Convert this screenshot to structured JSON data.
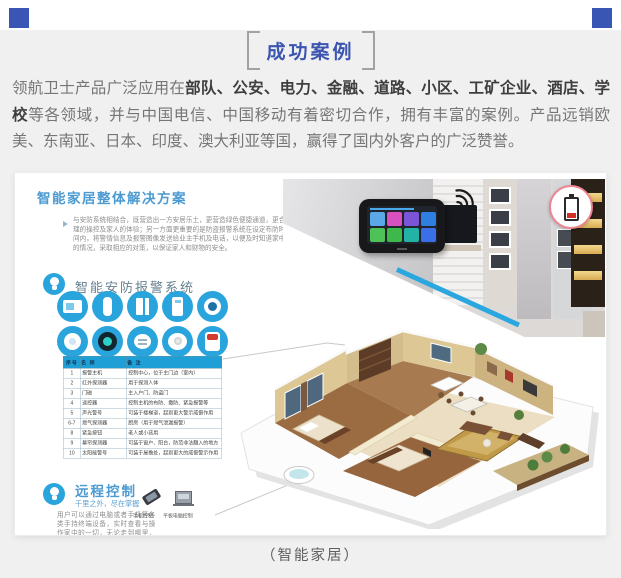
{
  "header": {
    "badge_title": "成功案例"
  },
  "intro": {
    "lead": "领航卫士产品广泛应用在",
    "bold_fields": "部队、公安、电力、金融、道路、小区、工矿企业、酒店、学校",
    "rest": "等各领域，并与中国电信、中国移动有着密切合作，拥有丰富的案例。产品远销欧美、东南亚、日本、印度、澳大利亚等国，赢得了国内外客户的广泛赞誉。"
  },
  "brochure": {
    "solution_title": "智能家居整体解决方案",
    "solution_intro": "与安防系统相结合，既营造出一方安居乐土，更营造绿色便捷通道，更合理的操控及家人的体验；另一方面更重要的是防盗报警系统在设定布防时间内，将警情信息及报警图像发送给业主手机及电话，以便及时知道家中的情况，采取相应的对策，以保证家人和财物的安全。",
    "security": {
      "title": "智能安防报警系统",
      "device_icons": [
        "alarm-host",
        "infrared-detector",
        "door-sensor",
        "remote-controller",
        "wired-siren",
        "smoke-detector",
        "smart-camera",
        "gas-detector",
        "sos-button",
        "strobe-siren"
      ]
    },
    "table": {
      "headers": [
        "序号",
        "名  称",
        "备  注"
      ],
      "rows": [
        [
          "1",
          "报警主机",
          "控制中心，位于主门边（室内）"
        ],
        [
          "2",
          "红外探测器",
          "用于探测人体"
        ],
        [
          "3",
          "门磁",
          "主入户门、防盗门"
        ],
        [
          "4",
          "遥控器",
          "控制主机的布防、撤防、紧急报警等"
        ],
        [
          "5",
          "声光警号",
          "可装于楼梯道，起到更大警示威慑作用"
        ],
        [
          "6-7",
          "燃气探测器",
          "厨房（用于燃气泄漏报警）"
        ],
        [
          "8",
          "紧急按钮",
          "老人或小孩用"
        ],
        [
          "9",
          "幕帘探测器",
          "可装于窗户、阳台，防范非法翻入的地方"
        ],
        [
          "10",
          "太阳能警号",
          "可装于屋檐处，起到更大的威慑警示作用"
        ]
      ]
    },
    "remote": {
      "title": "远程控制",
      "subtitle": "千里之外，尽在掌握",
      "body": "用户可以通过电脑或者手机等各类手持终端设备，实时查看与操作家中的一切，无论走到哪里，都可实现远程控制。",
      "devices": [
        {
          "label": "手机控制"
        },
        {
          "label": "平板电脑控制"
        }
      ]
    },
    "photo_icons": [
      "wifi-icon",
      "low-battery-icon"
    ]
  },
  "caption": "（智能家居）",
  "colors": {
    "corner_square": "#3a56b4",
    "badge_text": "#3b55b0",
    "section_blue": "#4c9ad2",
    "icon_blue": "#2aa4dc",
    "table_header_bg": "#1e9fd6",
    "accent_line": "#2ba7e0",
    "badge_ring": "#ee8593"
  }
}
